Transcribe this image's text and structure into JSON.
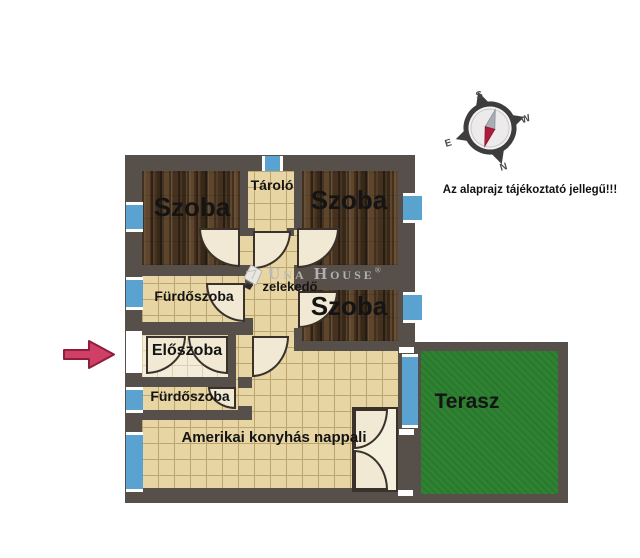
{
  "note": "Az alaprajz tájékoztató jellegű!!!",
  "rooms": {
    "szoba_top_left": "Szoba",
    "szoba_top_right": "Szoba",
    "szoba_middle": "Szoba",
    "tarolo": "Tároló",
    "furdoszoba_upper": "Fürdőszoba",
    "eloszoba": "Előszoba",
    "furdoszoba_lower": "Fürdőszoba",
    "kozlekedo": "zelekedő",
    "nappali": "Amerikai konyhás nappali",
    "terasz": "Terasz"
  },
  "compass": {
    "s": "S",
    "w": "W",
    "n": "N",
    "e": "E"
  },
  "watermark": {
    "brand": "Una House",
    "reg": "®"
  },
  "colors": {
    "wall": "#57504a",
    "wood": "#4a3421",
    "tile": "#e7d5a3",
    "tile-line": "#bca571",
    "cream": "#f3ecd9",
    "window": "#5aa2cf",
    "terrace": "#2e8231",
    "arrow": "#d04066",
    "label": "#141414"
  }
}
